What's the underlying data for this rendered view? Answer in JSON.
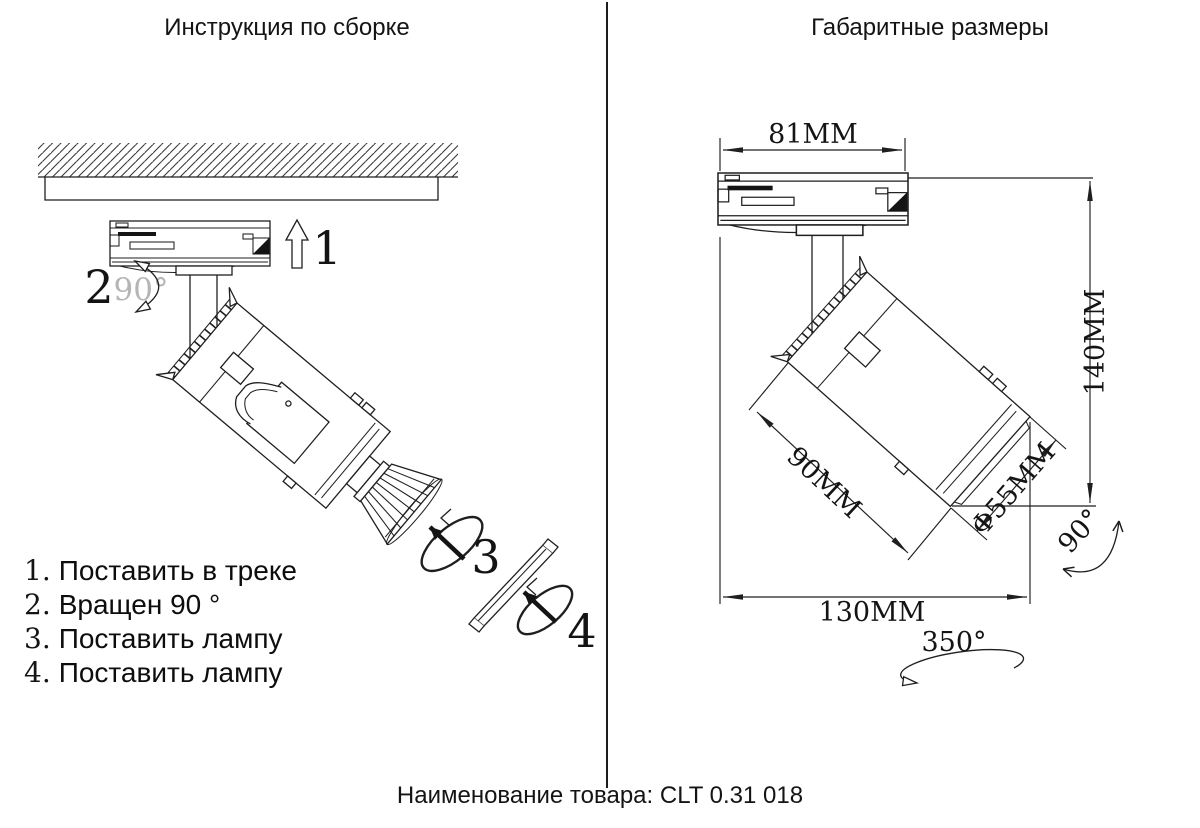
{
  "left_panel": {
    "title": "Инструкция по сборке",
    "steps": [
      {
        "num": "1.",
        "text": "Поставить в треке"
      },
      {
        "num": "2.",
        "text": "Вращен 90 °"
      },
      {
        "num": "3.",
        "text": "Поставить лампу"
      },
      {
        "num": "4.",
        "text": "Поставить лампу"
      }
    ],
    "callouts": {
      "c1": "1",
      "c2": "2",
      "c2_angle": "90°",
      "c3": "3",
      "c4": "4"
    }
  },
  "right_panel": {
    "title": "Габаритные размеры",
    "dims": {
      "adapter_width": "81MM",
      "overall_height": "140MM",
      "body_length": "90MM",
      "diameter": "Φ55MM",
      "overall_width": "130MM",
      "tilt_angle": "90°",
      "rotation_angle": "350°"
    }
  },
  "footer": {
    "label": "Наименование товара:",
    "value": "CLT 0.31 018"
  }
}
